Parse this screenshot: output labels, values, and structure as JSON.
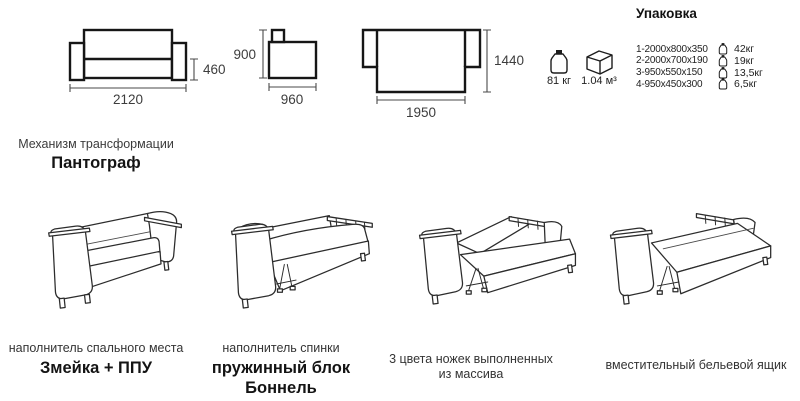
{
  "technical_views": {
    "front": {
      "width": "2120",
      "seat_height": "460"
    },
    "side": {
      "height": "900",
      "depth": "960"
    },
    "unfolded": {
      "length": "1950",
      "width": "1440"
    }
  },
  "totals": {
    "weight": "81 кг",
    "volume": "1.04 м³"
  },
  "packaging": {
    "title": "Упаковка",
    "items": [
      {
        "size": "1-2000x800x350",
        "weight": "42кг"
      },
      {
        "size": "2-2000x700x190",
        "weight": "19кг"
      },
      {
        "size": "3-950x550x150",
        "weight": "13,5кг"
      },
      {
        "size": "4-950x450x300",
        "weight": "6,5кг"
      }
    ]
  },
  "mechanism": {
    "label": "Механизм трансформации",
    "name": "Пантограф"
  },
  "features": [
    {
      "label": "наполнитель спального места",
      "value": "Змейка + ППУ"
    },
    {
      "label": "наполнитель спинки",
      "value": "пружинный блок Боннель"
    },
    {
      "label": "3 цвета ножек выполненных из массива",
      "value": ""
    },
    {
      "label": "вместительный бельевой ящик",
      "value": ""
    }
  ],
  "colors": {
    "line_art": "#2c2c2c",
    "tech_line": "#161616",
    "text_primary": "#141414",
    "text_secondary": "#3d3d3d"
  }
}
